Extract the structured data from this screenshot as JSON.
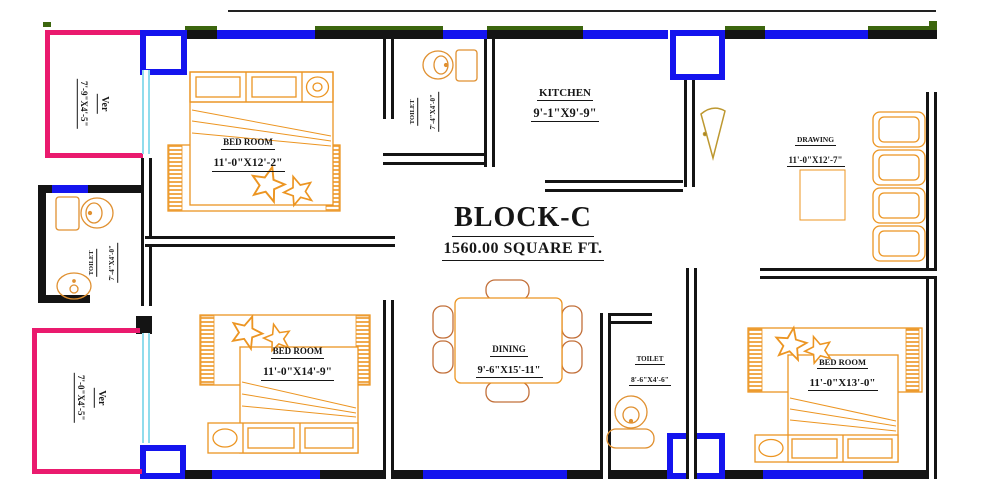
{
  "title": {
    "name": "BLOCK-C",
    "area": "1560.00 SQUARE FT."
  },
  "rooms": {
    "bedroom1": {
      "name": "BED ROOM",
      "dims": "11'-0\"X12'-2\""
    },
    "toilet_top": {
      "name": "TOILET",
      "dims": "7'-4\"X4'-0\""
    },
    "kitchen": {
      "name": "KITCHEN",
      "dims": "9'-1\"X9'-9\""
    },
    "drawing": {
      "name": "DRAWING",
      "dims": "11'-0\"X12'-7\""
    },
    "verandah_top": {
      "name": "Ver",
      "dims": "7'-9\"X4'-5\""
    },
    "toilet_left": {
      "name": "TOILET",
      "dims": "7'-4\"X4'-0\""
    },
    "verandah_bottom": {
      "name": "Ver",
      "dims": "7'-0\"X4'-5\""
    },
    "bedroom2": {
      "name": "BED ROOM",
      "dims": "11'-0\"X14'-9\""
    },
    "dining": {
      "name": "DINING",
      "dims": "9'-6\"X15'-11\""
    },
    "toilet_bottom": {
      "name": "TOILET",
      "dims": "8'-6\"X4'-6\""
    },
    "bedroom3": {
      "name": "BED ROOM",
      "dims": "11'-0\"X13'-0\""
    }
  },
  "colors": {
    "wall": "#141414",
    "window_blue": "#1414ee",
    "window_green": "#3c660e",
    "verandah_pink": "#ea1a6e",
    "glass_cyan": "#8fdcec",
    "furniture_orange": "#ec9522",
    "chair_brown": "#c2703a",
    "door_gold": "#bd9830"
  }
}
